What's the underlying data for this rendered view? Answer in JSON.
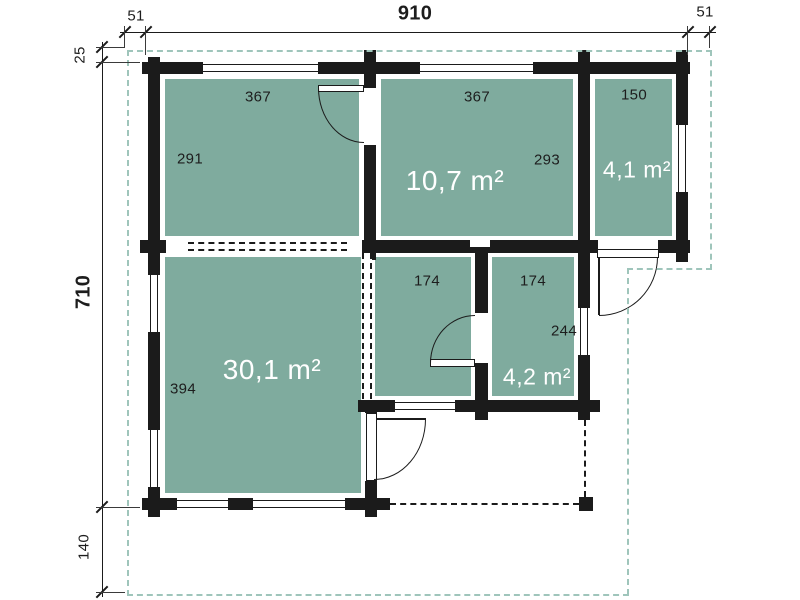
{
  "colors": {
    "room_fill": "#7fab9e",
    "wall": "#1b1b1b",
    "roof_outline_dash": "#9fc5bb",
    "terrace_dash": "#1b1b1b",
    "dim_text": "#1d1d1d",
    "area_text": "#ffffff"
  },
  "dimensions": {
    "top": {
      "left_overhang": "51",
      "total_width": "910",
      "right_overhang": "51"
    },
    "left": {
      "top_offset": "25",
      "total_depth": "710",
      "bottom_offset": "140"
    }
  },
  "rooms": {
    "top_left": {
      "width": "367",
      "depth": "291"
    },
    "top_middle": {
      "width": "367",
      "depth": "293",
      "area": "10,7 m²"
    },
    "top_right": {
      "width": "150",
      "area": "4,1 m²"
    },
    "mid_left": {
      "width": "174"
    },
    "mid_right": {
      "width": "174",
      "depth": "244",
      "area": "4,2 m²"
    },
    "bottom_left": {
      "depth": "394",
      "area": "30,1 m²"
    }
  }
}
